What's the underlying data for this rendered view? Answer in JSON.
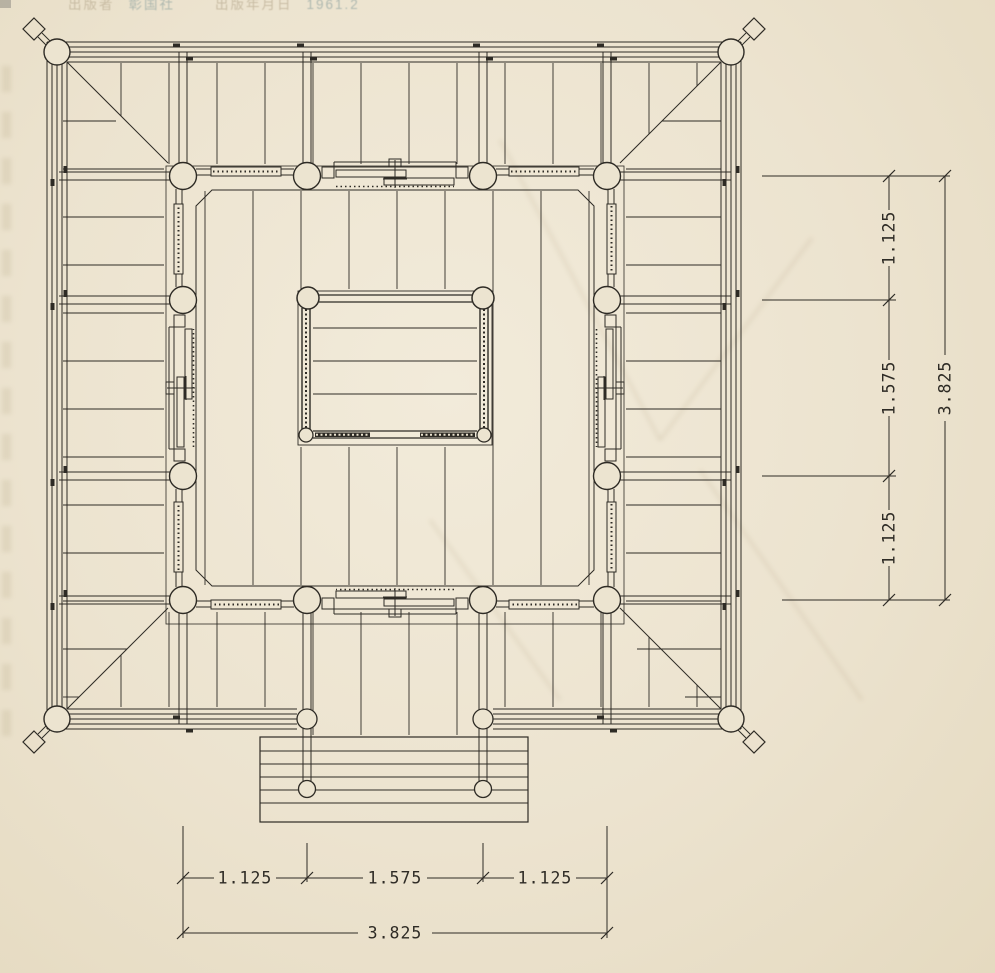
{
  "colors": {
    "paper": "#ece4d0",
    "ink": "#2e2b25",
    "header_label": "#bdb096",
    "header_value": "#9aaaa5"
  },
  "header_overlay": {
    "publisher_label": "出版者",
    "publisher_value": "彰国社",
    "date_label": "出版年月日",
    "date_value": "1961.2"
  },
  "dimensions": {
    "right": {
      "segments": [
        "1.125",
        "1.575",
        "1.125"
      ],
      "total": "3.825"
    },
    "bottom": {
      "segments": [
        "1.125",
        "1.575",
        "1.125"
      ],
      "total": "3.825"
    }
  }
}
